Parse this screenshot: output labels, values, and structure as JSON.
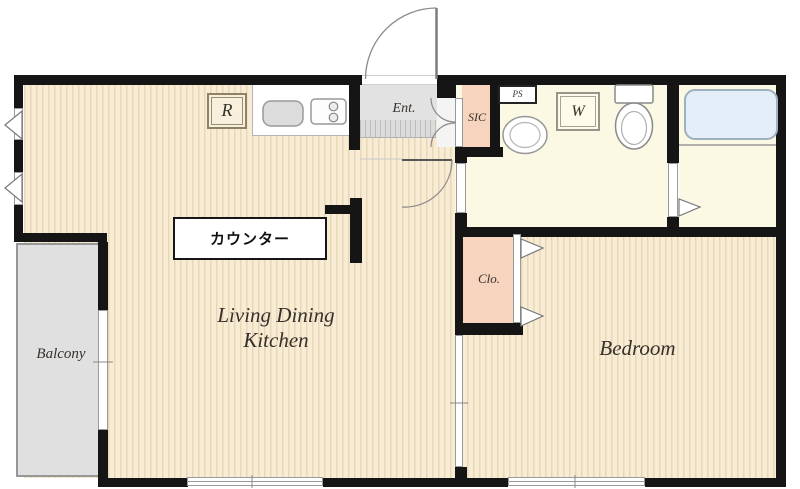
{
  "rooms": {
    "ldk": {
      "label_line1": "Living Dining",
      "label_line2": "Kitchen"
    },
    "bedroom": {
      "label": "Bedroom"
    },
    "balcony": {
      "label": "Balcony"
    },
    "entrance": {
      "label": "Ent."
    },
    "shoe_closet": {
      "label": "SIC"
    },
    "closet": {
      "label": "Clo."
    },
    "pipe_space": {
      "label": "PS"
    },
    "washer": {
      "label": "W"
    },
    "refrigerator": {
      "label": "R"
    },
    "counter": {
      "label": "カウンター"
    }
  },
  "colors": {
    "wall": "#151515",
    "wood_floor": "#f8ecd4",
    "wood_stripe": "#e9d8b8",
    "wet_floor": "#fbf8e4",
    "closet_fill": "#f6d4bd",
    "entrance_grey": "#e2e2e2",
    "balcony_grey": "#e0e0e0",
    "bathtub_blue": "#e3eef9"
  }
}
